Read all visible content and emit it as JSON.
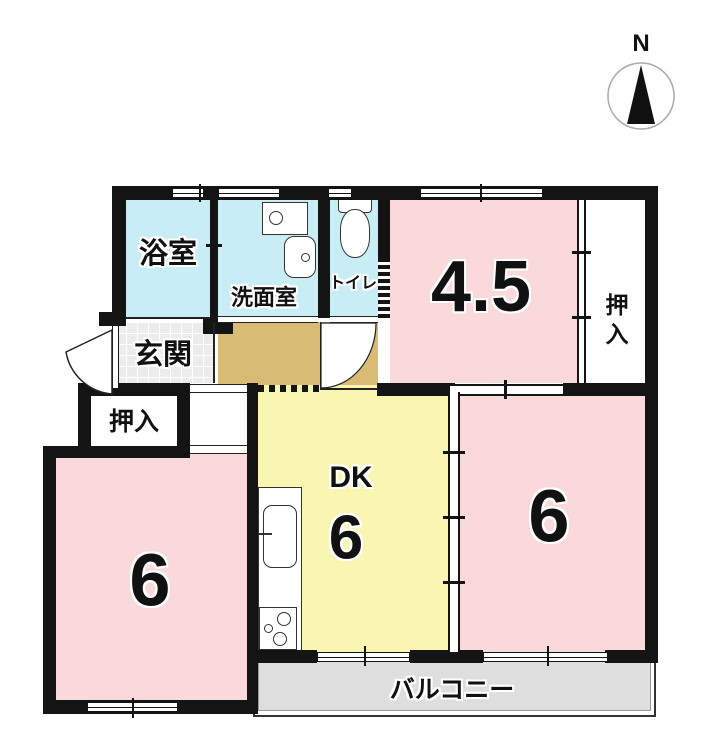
{
  "compass": {
    "label": "N"
  },
  "rooms": {
    "bath": {
      "label": "浴室"
    },
    "washroom": {
      "label": "洗面室"
    },
    "toilet": {
      "label": "トイレ"
    },
    "entrance": {
      "label": "玄関"
    },
    "closet_upper_right": {
      "label": "押入"
    },
    "closet_left": {
      "label": "押入"
    },
    "tatami_45": {
      "label": "4.5"
    },
    "dk": {
      "label": "DK",
      "size": "6"
    },
    "room6_right": {
      "label": "6"
    },
    "room6_left": {
      "label": "6"
    },
    "balcony": {
      "label": "バルコニー"
    }
  },
  "colors": {
    "wall": "#141414",
    "tatami_room": "#f9d9d9",
    "wet_area": "#c9edf4",
    "dining_kitchen": "#f8f6b0",
    "hallway": "#d8bc74",
    "entrance_tile": "#ececec",
    "balcony": "#dedede"
  },
  "icons": {
    "compass_arrow": "north-arrow",
    "fixtures": [
      "washing-machine",
      "wash-basin",
      "toilet-bowl",
      "kitchen-sink",
      "stove"
    ]
  }
}
